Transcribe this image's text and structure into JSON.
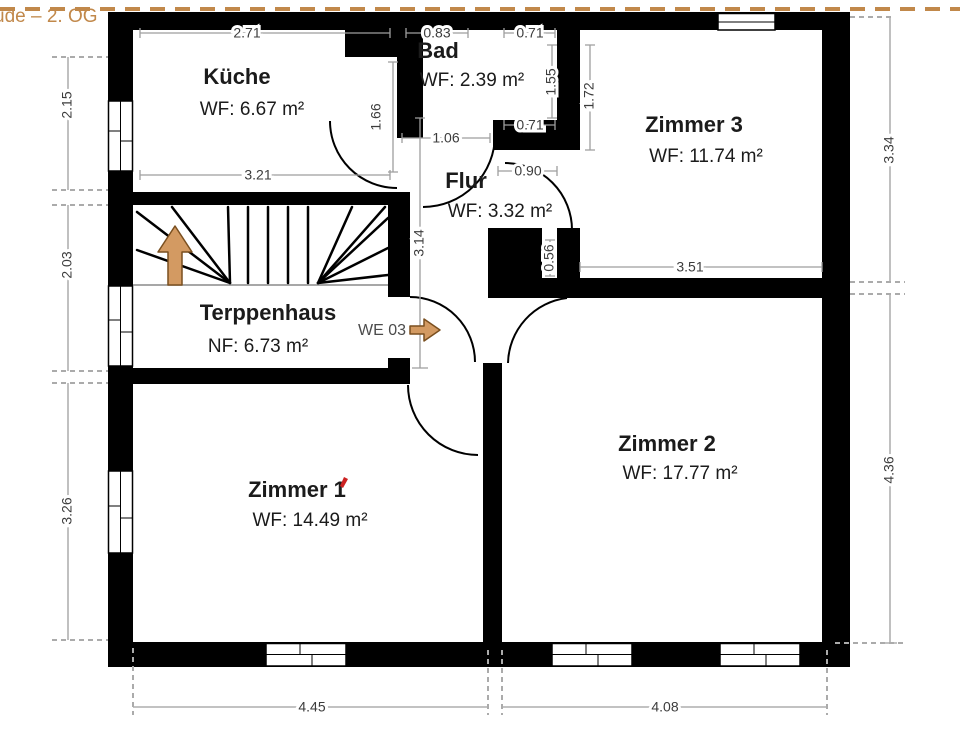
{
  "title": "ude – 2. OG",
  "unit_label": "WE 03",
  "colors": {
    "accent_dashed_line": "#c1884a",
    "wall": "#000000",
    "dimension_line": "#9e9e9e",
    "arrow_fill": "#d39a62",
    "red_mark": "#cc2222"
  },
  "rooms": {
    "kueche": {
      "name": "Küche",
      "area": "WF: 6.67 m²"
    },
    "bad": {
      "name": "Bad",
      "area": "WF: 2.39 m²"
    },
    "zimmer3": {
      "name": "Zimmer 3",
      "area": "WF: 11.74 m²"
    },
    "flur": {
      "name": "Flur",
      "area": "WF: 3.32 m²"
    },
    "treppenhaus": {
      "name": "Terppenhaus",
      "area": "NF: 6.73 m²"
    },
    "zimmer1": {
      "name": "Zimmer 1",
      "area": "WF: 14.49 m²"
    },
    "zimmer2": {
      "name": "Zimmer 2",
      "area": "WF: 17.77 m²"
    }
  },
  "dims": {
    "kueche_top": "2.71",
    "kueche_bottom": "3.21",
    "kueche_door": "1.66",
    "bad_top_left": "0.83",
    "bad_top_right": "0.71",
    "bad_right": "1.55",
    "zimmer3_left": "1.72",
    "bad_bottom": "1.06",
    "bad_bottom_right": "0.71",
    "flur_opening": "0.90",
    "flur_height": "3.14",
    "zimmer3_stub": "0.56",
    "zimmer3_width": "3.51",
    "left_top": "2.15",
    "left_mid": "2.03",
    "left_bottom": "3.26",
    "right_top": "3.34",
    "right_bottom": "4.36",
    "bottom_left": "4.45",
    "bottom_right": "4.08"
  }
}
